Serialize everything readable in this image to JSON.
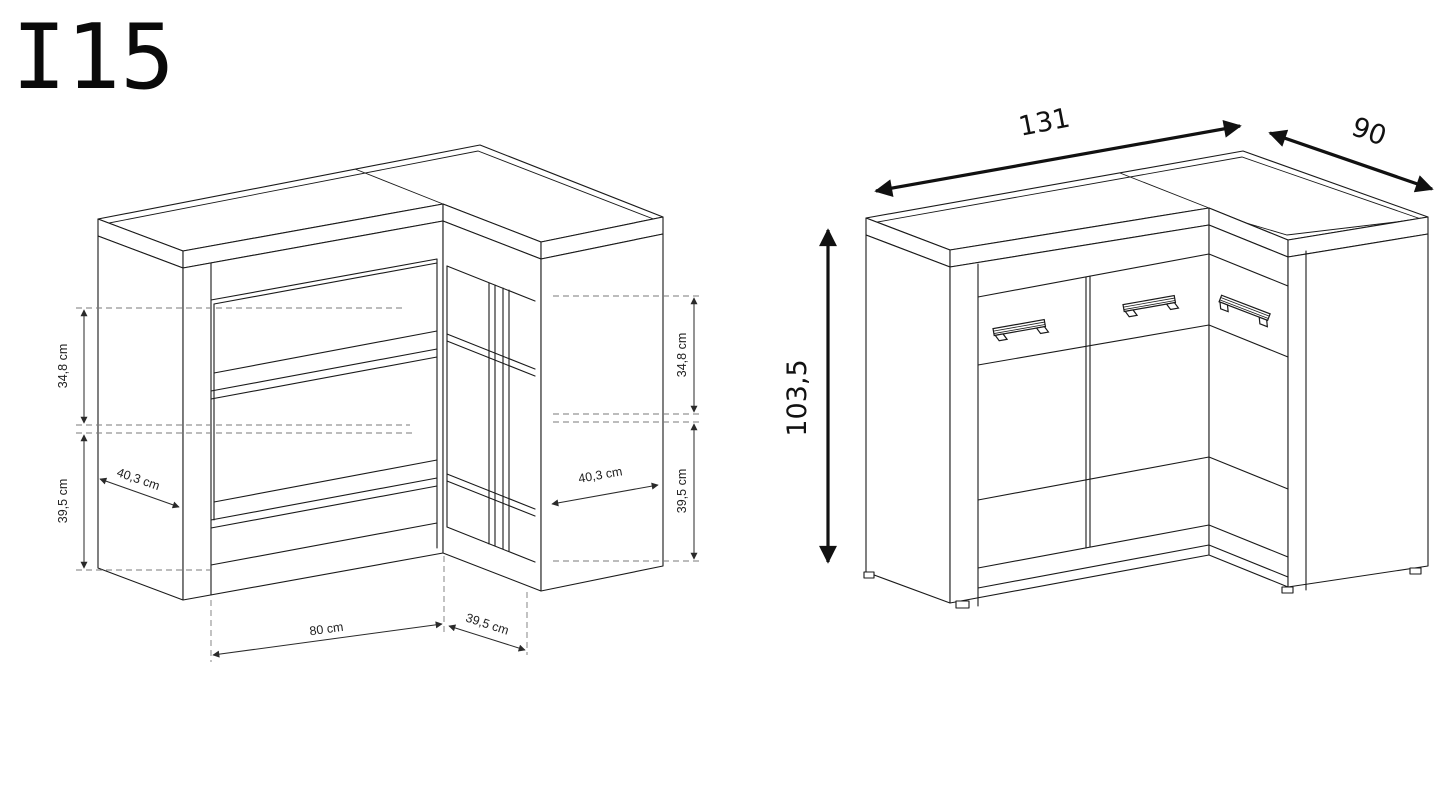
{
  "title": "I15",
  "left_view": {
    "description": "interior dimensions view of corner cabinet",
    "labels": {
      "left_upper": "34,8 cm",
      "left_lower": "39,5 cm",
      "left_depth": "40,3 cm",
      "right_upper": "34,8 cm",
      "right_lower": "39,5 cm",
      "right_depth": "40,3 cm",
      "bottom_width": "80 cm",
      "bottom_depth": "39,5 cm"
    }
  },
  "right_view": {
    "description": "exterior overall dimensions view of corner cabinet",
    "labels": {
      "width": "131",
      "depth": "90",
      "height": "103,5"
    }
  },
  "colors": {
    "line": "#1a1a1a",
    "dashed_line": "#7a7a7a",
    "background": "#ffffff"
  }
}
